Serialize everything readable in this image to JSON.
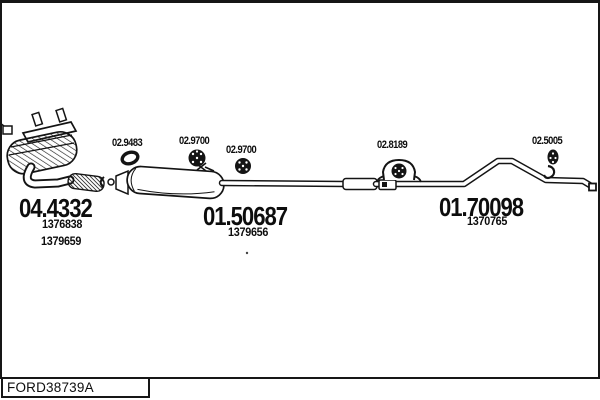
{
  "footer": {
    "drawing_code": "FORD38739A"
  },
  "colors": {
    "ink": "#141414",
    "background": "#ffffff"
  },
  "diagram": {
    "part_labels": [
      {
        "label": "02.9483",
        "icon": "gasket-ring-icon"
      },
      {
        "label": "02.9700",
        "icon": "rubber-mount-icon"
      },
      {
        "label": "02.9700",
        "icon": "rubber-mount-icon"
      },
      {
        "label": "02.8189",
        "icon": "hanger-clamp-icon"
      },
      {
        "label": "02.5005",
        "icon": "rubber-mount-icon"
      }
    ],
    "assemblies": [
      {
        "code": "04.4332",
        "refs": [
          "1376838",
          "1379659"
        ]
      },
      {
        "code": "01.50687",
        "refs": [
          "1379656"
        ]
      },
      {
        "code": "01.70098",
        "refs": [
          "1370765"
        ]
      }
    ]
  }
}
